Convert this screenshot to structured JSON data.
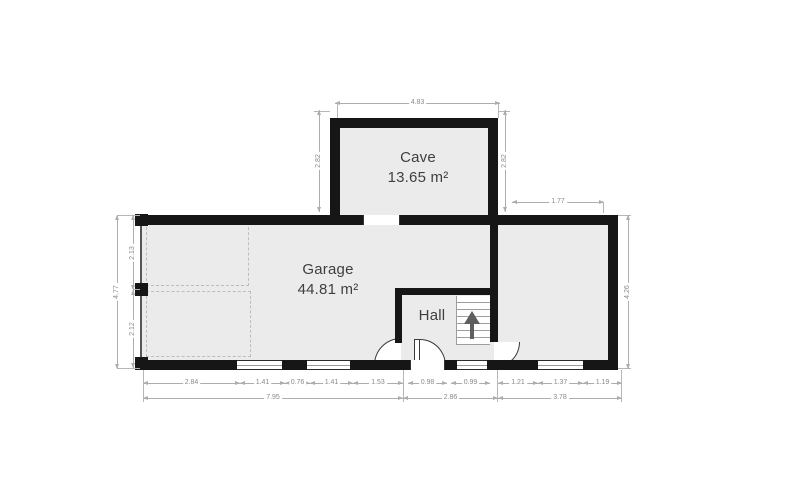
{
  "rooms": {
    "cave": {
      "name": "Cave",
      "area": "13.65 m²"
    },
    "garage": {
      "name": "Garage",
      "area": "44.81 m²"
    },
    "hall": {
      "name": "Hall"
    }
  },
  "dims": {
    "cave_top": "4.83",
    "cave_left": "2.82",
    "cave_right": "2.82",
    "annex_top": "1.77",
    "left_outer": "4.77",
    "left_upper": "2.13",
    "left_lower": "2.12",
    "right_outer": "4.26",
    "row1": [
      "2.84",
      "1.41",
      "0.76",
      "1.41",
      "1.53",
      "0.98",
      "0.99",
      "1.21",
      "1.37",
      "1.19"
    ],
    "row2": [
      "7.95",
      "2.86",
      "3.78"
    ]
  },
  "colors": {
    "wall": "#161616",
    "room_fill": "#ebebeb",
    "dim_line": "#adadad",
    "dim_text": "#8a8a8a",
    "label_text": "#3f3f3f",
    "background": "#ffffff"
  },
  "icons": {
    "stairs_direction": "arrow-up-icon"
  }
}
